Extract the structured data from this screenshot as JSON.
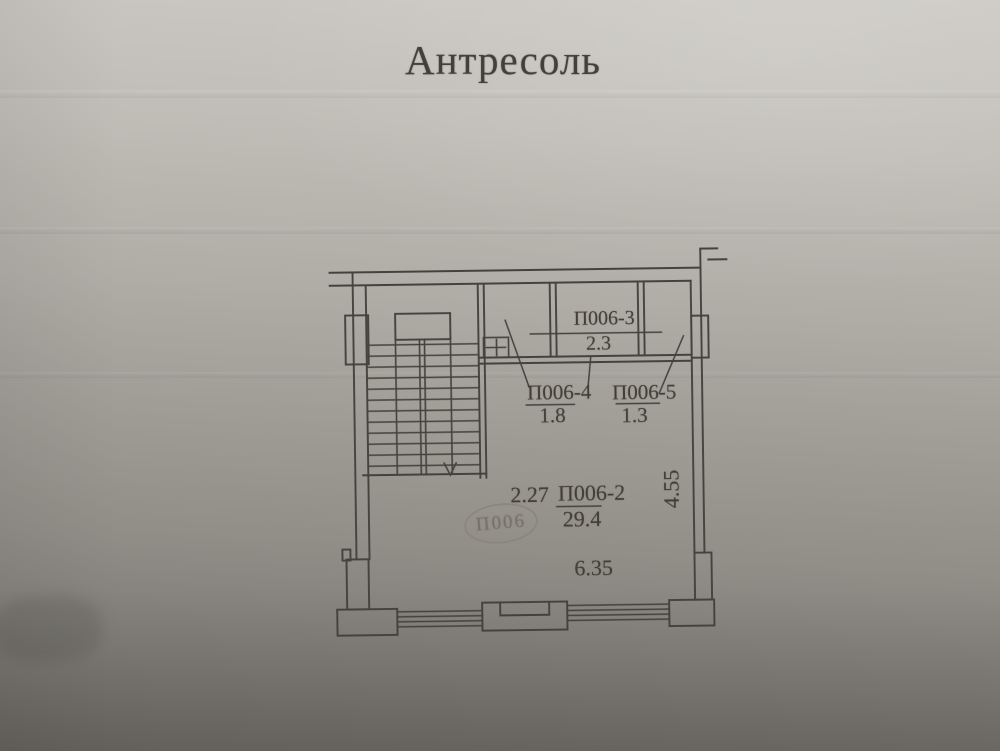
{
  "title": "Антресоль",
  "plan": {
    "rooms": [
      {
        "id": "П006-3",
        "area": "2.3"
      },
      {
        "id": "П006-4",
        "area": "1.8"
      },
      {
        "id": "П006-5",
        "area": "1.3"
      },
      {
        "id": "П006-2",
        "area": "29.4"
      }
    ],
    "dimensions": [
      "2.27",
      "6.35",
      "4.55"
    ],
    "stamp": "П006"
  },
  "colors": {
    "ink": "#45423d",
    "stamp_ink": "#8a857e",
    "paper_top": "#c9c6c1",
    "paper_bottom": "#6b6864"
  }
}
